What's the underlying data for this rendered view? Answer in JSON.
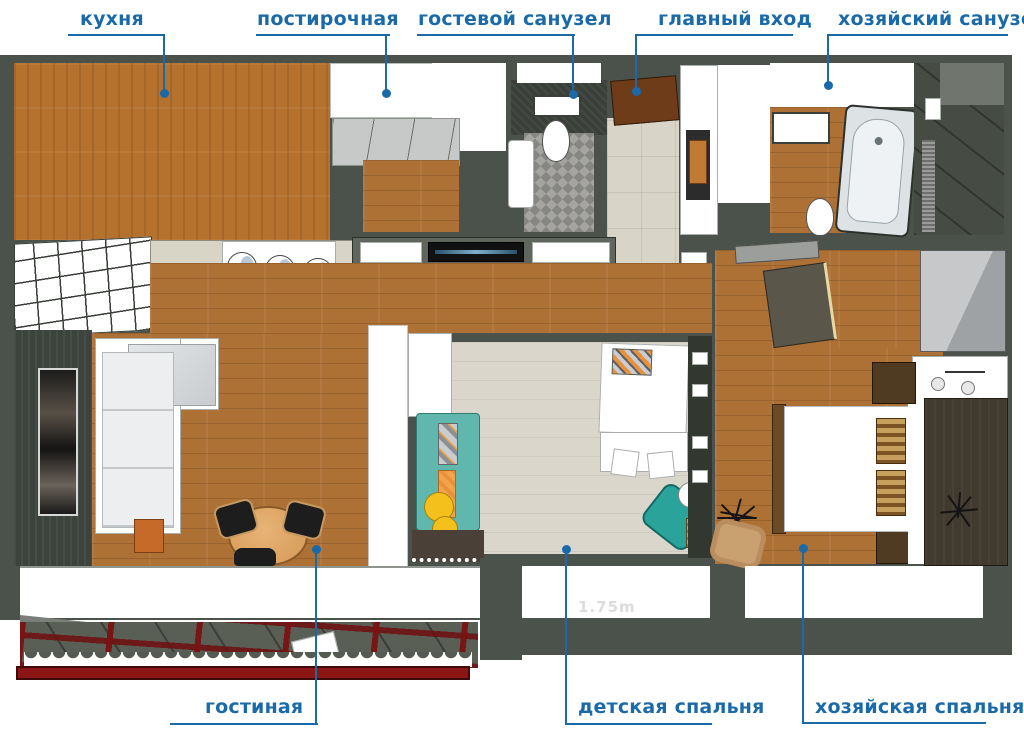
{
  "annotations": {
    "accent_color": "#1a6aa9",
    "items": [
      {
        "id": "kitchen",
        "label": "кухня"
      },
      {
        "id": "laundry",
        "label": "постирочная"
      },
      {
        "id": "guest-bathroom",
        "label": "гостевой санузел"
      },
      {
        "id": "main-entrance",
        "label": "главный вход"
      },
      {
        "id": "master-bathroom",
        "label": "хозяйский санузел"
      },
      {
        "id": "living-room",
        "label": "гостиная"
      },
      {
        "id": "children-bedroom",
        "label": "детская спальня"
      },
      {
        "id": "master-bedroom",
        "label": "хозяйская спальня"
      }
    ]
  },
  "watermark": "1.75m",
  "palette": {
    "annotation_blue": "#1a6aa9",
    "wall": "#4b524b",
    "wood_floor": "#ad7136",
    "kitchen_counter_wood": "#b5722e",
    "children_floor": "#dad6cc",
    "entry_tile": "#d8d4c8",
    "bathroom_mosaic": "#a5a4a0",
    "teal_sofa": "#5fb7ae",
    "beanbag_teal": "#2aa39b",
    "orange_accent": "#f2a44d",
    "yellow_accent": "#f3c01c",
    "balcony_red": "#8c1616",
    "dark_accent_wall": "#413a2e",
    "entry_door_brown": "#6e3c19",
    "watermark_gray": "#dcdcdc"
  }
}
